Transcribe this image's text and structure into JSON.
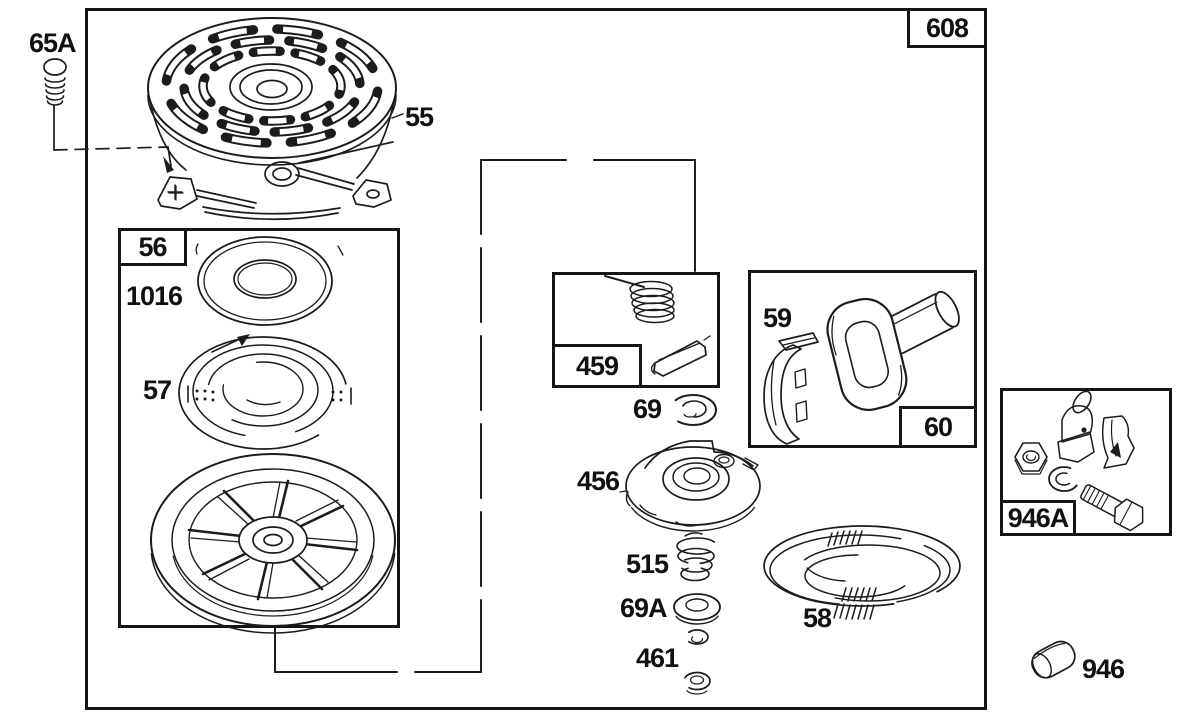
{
  "figure": {
    "type": "exploded-parts-diagram",
    "colors": {
      "line": "#1c1c1c",
      "background": "#ffffff",
      "text": "#111111"
    }
  },
  "boxes": {
    "b608": {
      "label": "608"
    },
    "b56": {
      "label": "56"
    },
    "b459": {
      "label": "459"
    },
    "b60": {
      "label": "60"
    },
    "b946a": {
      "label": "946A"
    }
  },
  "parts": {
    "p65a": {
      "label": "65A"
    },
    "p55": {
      "label": "55"
    },
    "p1016": {
      "label": "1016"
    },
    "p57": {
      "label": "57"
    },
    "p69": {
      "label": "69"
    },
    "p456": {
      "label": "456"
    },
    "p515": {
      "label": "515"
    },
    "p69a": {
      "label": "69A"
    },
    "p461": {
      "label": "461"
    },
    "p59": {
      "label": "59"
    },
    "p58": {
      "label": "58"
    },
    "p946": {
      "label": "946"
    }
  }
}
